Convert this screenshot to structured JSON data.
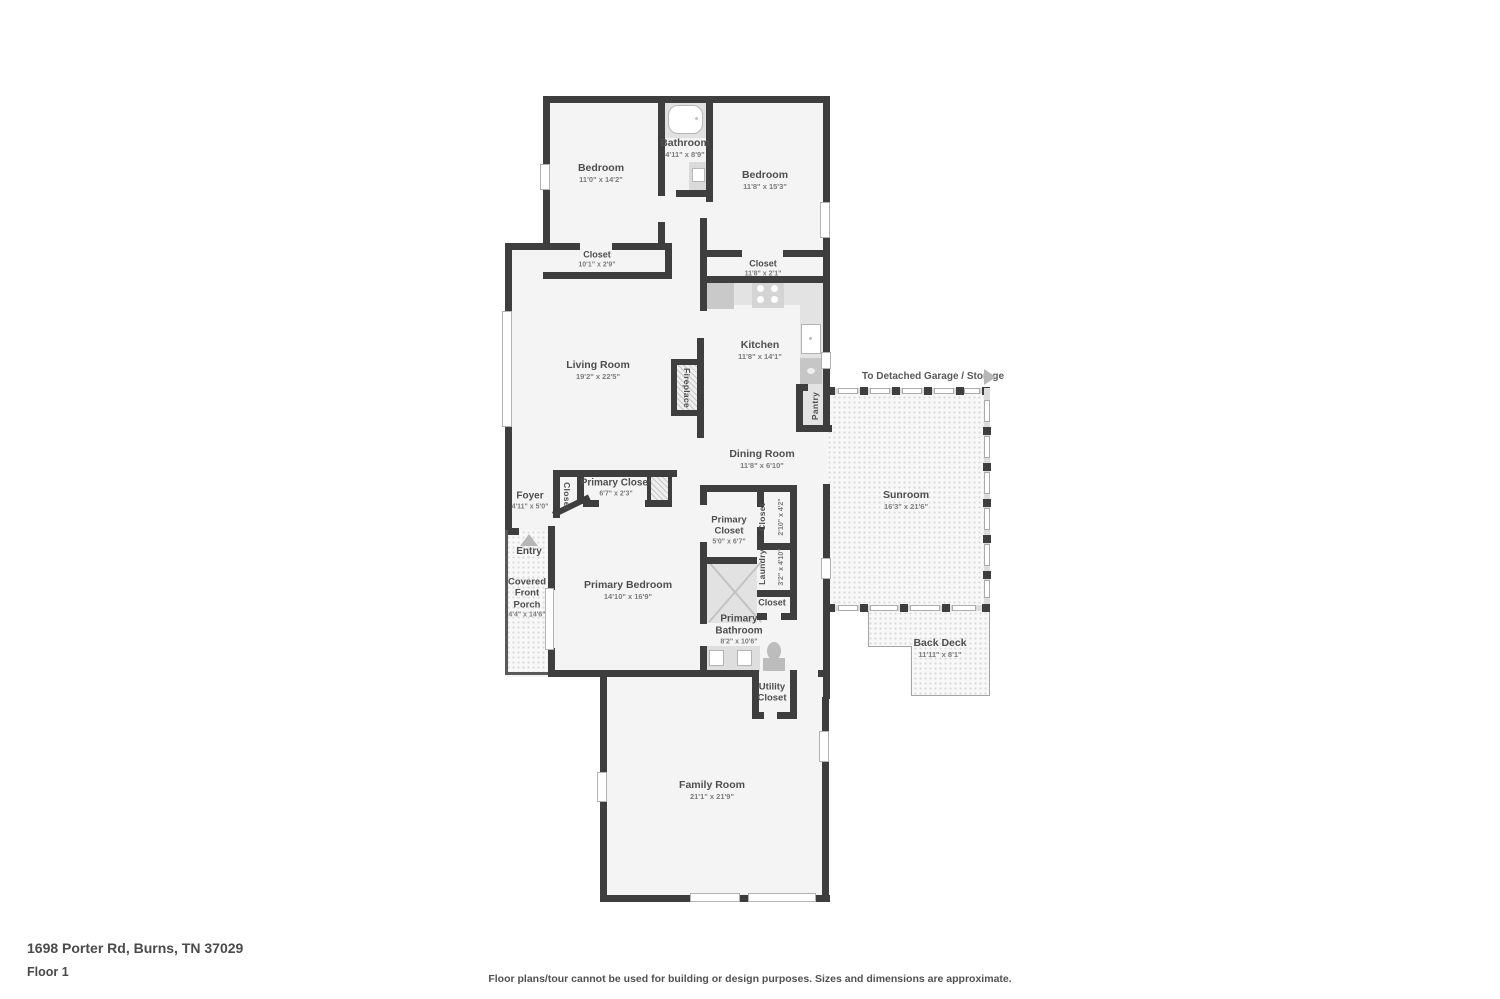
{
  "meta": {
    "address": "1698 Porter Rd, Burns, TN 37029",
    "floor_label": "Floor 1",
    "disclaimer": "Floor plans/tour cannot be used for building or design purposes. Sizes and dimensions are approximate."
  },
  "annotations": {
    "garage_note": "To Detached Garage / Storage",
    "entry_label": "Entry"
  },
  "colors": {
    "wall": "#3e3e3e",
    "floor": "#f4f4f4",
    "label_text": "#4e4e4e",
    "dim_text": "#7c7c7c",
    "arrow": "#b7b7b7"
  },
  "rooms": {
    "bedroom_left": {
      "name": "Bedroom",
      "dims": "11'0\" x 14'2\""
    },
    "bathroom": {
      "name": "Bathroom",
      "dims": "4'11\" x 8'9\""
    },
    "bedroom_right": {
      "name": "Bedroom",
      "dims": "11'8\" x 15'3\""
    },
    "closet_bedroom_left": {
      "name": "Closet",
      "dims": "10'1\" x 2'9\""
    },
    "closet_bedroom_right": {
      "name": "Closet",
      "dims": "11'8\" x 2'1\""
    },
    "living_room": {
      "name": "Living Room",
      "dims": "19'2\" x 22'5\""
    },
    "fireplace": {
      "name": "Fireplace"
    },
    "kitchen": {
      "name": "Kitchen",
      "dims": "11'8\" x 14'1\""
    },
    "pantry": {
      "name": "Pantry"
    },
    "dining_room": {
      "name": "Dining Room",
      "dims": "11'8\" x 6'10\""
    },
    "sunroom": {
      "name": "Sunroom",
      "dims": "16'3\" x 21'6\""
    },
    "primary_closet_hall": {
      "name": "Primary Closet",
      "dims": "6'7\" x 2'3\""
    },
    "closet_foyer": {
      "name": "Closet"
    },
    "foyer": {
      "name": "Foyer",
      "dims": "4'11\" x 5'0\""
    },
    "covered_front_porch": {
      "name": "Covered Front Porch",
      "dims": "4'4\" x 14'6\""
    },
    "primary_bedroom": {
      "name": "Primary Bedroom",
      "dims": "14'10\" x 16'9\""
    },
    "primary_closet": {
      "name": "Primary Closet",
      "dims": "5'0\" x 6'7\""
    },
    "closet_hall": {
      "name": "Closet",
      "dims": "2'10\" x 4'2\""
    },
    "laundry": {
      "name": "Laundry",
      "dims": "3'2\" x 4'10\""
    },
    "closet_bath": {
      "name": "Closet"
    },
    "primary_bathroom": {
      "name": "Primary Bathroom",
      "dims": "8'2\" x 10'6\""
    },
    "utility_closet": {
      "name": "Utility Closet"
    },
    "back_deck": {
      "name": "Back Deck",
      "dims": "11'11\" x 8'1\""
    },
    "family_room": {
      "name": "Family Room",
      "dims": "21'1\" x 21'9\""
    }
  }
}
